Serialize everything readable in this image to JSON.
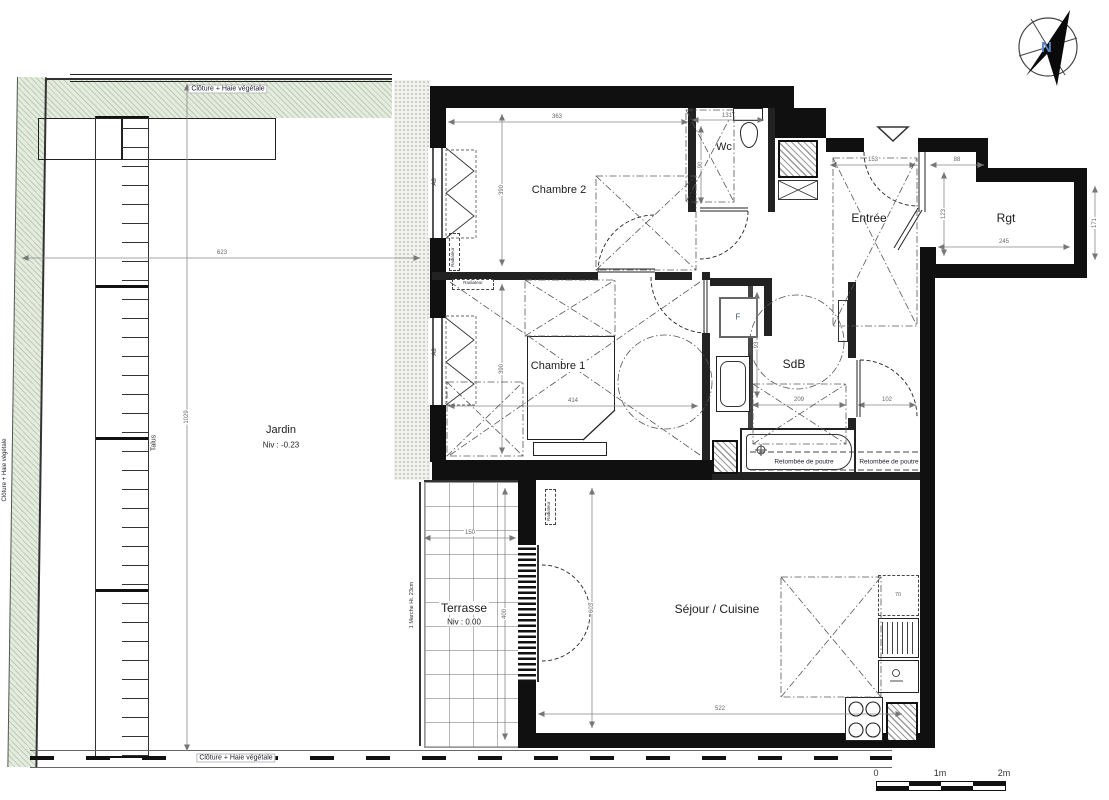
{
  "rooms": {
    "chambre2": {
      "name": "Chambre 2"
    },
    "wc": {
      "name": "Wc"
    },
    "entree": {
      "name": "Entrée"
    },
    "rgt": {
      "name": "Rgt"
    },
    "chambre1": {
      "name": "Chambre 1"
    },
    "sdb": {
      "name": "SdB"
    },
    "sejour": {
      "name": "Séjour / Cuisine"
    }
  },
  "garden": {
    "name": "Jardin",
    "level": "Niv : -0.23"
  },
  "terrace": {
    "name": "Terrasse",
    "level": "Niv : 0.00"
  },
  "fence_label": "Clôture + Haie végétale",
  "annotations": {
    "talus": "Talus",
    "step": "1 Marche Ht. 23cm",
    "beam": "Retombée de poutre",
    "radiator": "Radiateur",
    "window_tag": "A8",
    "duct": "F",
    "fridge": "70"
  },
  "dims": [
    {
      "v": "363"
    },
    {
      "v": "390"
    },
    {
      "v": "131"
    },
    {
      "v": "90"
    },
    {
      "v": "153"
    },
    {
      "v": "88"
    },
    {
      "v": "123"
    },
    {
      "v": "245"
    },
    {
      "v": "171"
    },
    {
      "v": "414"
    },
    {
      "v": "390"
    },
    {
      "v": "209"
    },
    {
      "v": "102"
    },
    {
      "v": "93"
    },
    {
      "v": "150"
    },
    {
      "v": "400"
    },
    {
      "v": "603"
    },
    {
      "v": "522"
    },
    {
      "v": "623"
    },
    {
      "v": "1029"
    }
  ],
  "scale_bar": {
    "t0": "0",
    "t1": "1m",
    "t2": "2m"
  },
  "compass": {
    "north": "N"
  },
  "colors": {
    "wall": "#101010",
    "hedge": "#e3ecdd",
    "dim_text": "#666666",
    "north_letter": "#5b86c8"
  }
}
